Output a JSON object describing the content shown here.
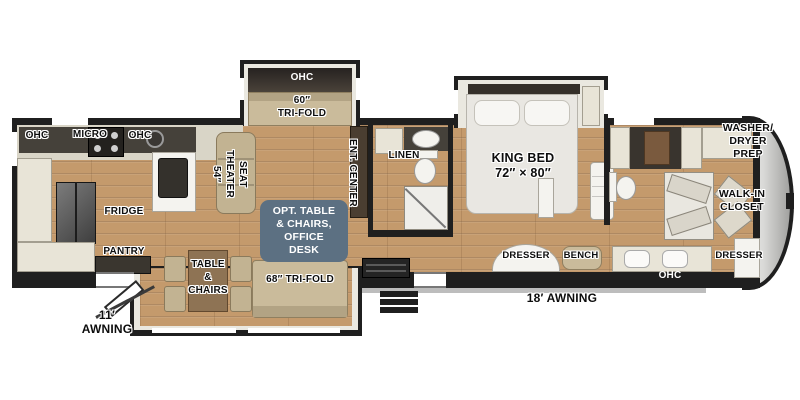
{
  "title": "Fifth wheel RV floor plan",
  "labels": {
    "kitchen_ohc_left": "OHC",
    "kitchen_micro": "MICRO",
    "kitchen_ohc_right": "OHC",
    "fridge": "FRIDGE",
    "pantry": "PANTRY",
    "theater_seat": "54″\nTHEATER\nSEAT",
    "slide_ohc": "OHC",
    "trifold_60": "60″\nTRI-FOLD",
    "ent_center": "ENT. CENTER",
    "option_box": "OPT. TABLE\n& CHAIRS,\nOFFICE\nDESK",
    "dinette": "TABLE\n&\nCHAIRS",
    "trifold_68": "68″ TRI-FOLD",
    "linen": "LINEN",
    "king_bed": "KING BED\n72″ × 80″",
    "dresser_bedroom": "DRESSER",
    "bench": "BENCH",
    "washer_dryer_prep": "WASHER/\nDRYER\nPREP",
    "walk_in_closet": "WALK-IN\nCLOSET",
    "dresser_front": "DRESSER",
    "bath_ohc": "OHC",
    "awning_rear": "11′\nAWNING",
    "awning_main": "18′ AWNING"
  },
  "colors": {
    "walls": "#1f1f1f",
    "wood_floor": "#c49a6c",
    "sofa_tan": "#cabb9b",
    "cabinet_cream": "#e8e4d7",
    "option_box_blue": "#5c7082",
    "front_cap_gray": "#a7a7a5"
  }
}
